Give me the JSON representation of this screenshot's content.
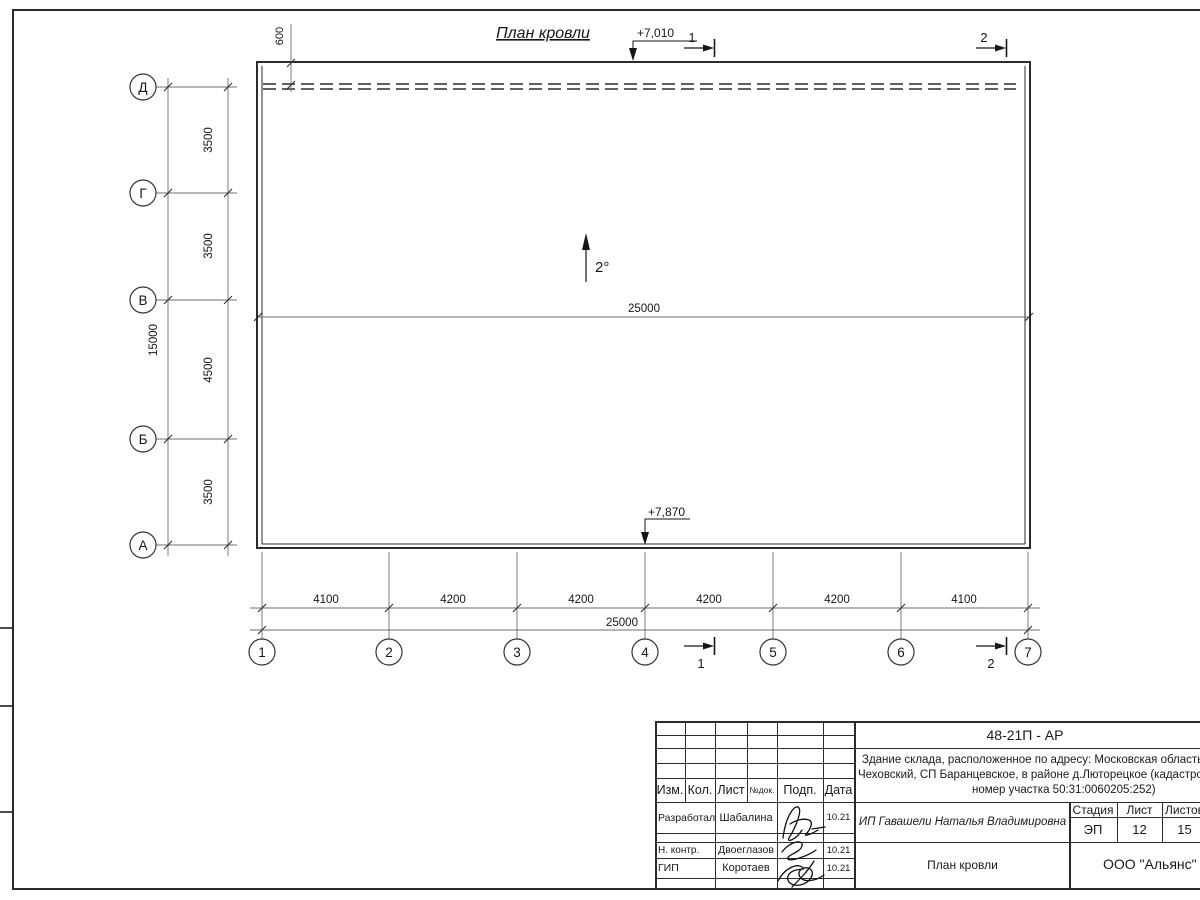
{
  "drawing": {
    "title": "План кровли",
    "slope": "2°",
    "elevations": {
      "top": "+7,010",
      "bottom": "+7,870"
    },
    "dims": {
      "parapet": "600",
      "internal_total": "25000",
      "bottom_total": "25000",
      "left_total": "15000",
      "left_segments": [
        "3500",
        "3500",
        "4500",
        "3500"
      ],
      "bottom_segments": [
        "4100",
        "4200",
        "4200",
        "4200",
        "4200",
        "4100"
      ]
    },
    "axes": {
      "rows": [
        "Д",
        "Г",
        "В",
        "Б",
        "А"
      ],
      "cols": [
        "1",
        "2",
        "3",
        "4",
        "5",
        "6",
        "7"
      ]
    },
    "sections": {
      "one": "1",
      "two": "2"
    }
  },
  "titleblock": {
    "doc_code": "48-21П - АР",
    "description": [
      "Здание склада, расположенное по адресу: Московская область, р-н",
      "Чеховский, СП Баранцевское, в районе д.Люторецкое  (кадастровый",
      "номер участка 50:31:0060205:252)"
    ],
    "rev_headers": [
      "Изм.",
      "Кол.",
      "Лист",
      "№док.",
      "Подп.",
      "Дата"
    ],
    "signature_rows": [
      {
        "role": "Разработал",
        "name": "Шабалина",
        "date": "10.21"
      },
      {
        "role": "Н. контр.",
        "name": "Двоеглазов",
        "date": "10.21"
      },
      {
        "role": "ГИП",
        "name": "Коротаев",
        "date": "10.21"
      }
    ],
    "client": "ИП Гавашели Наталья Владимировна",
    "sheet_title": "План кровли",
    "company": "ООО \"Альянс\"",
    "stage": {
      "label": "Стадия",
      "value": "ЭП"
    },
    "sheet": {
      "label": "Лист",
      "value": "12"
    },
    "sheets": {
      "label": "Листов",
      "value": "15"
    }
  },
  "colors": {
    "line": "#2b2b2b",
    "dim": "#6e6e6e",
    "bg": "#ffffff"
  }
}
